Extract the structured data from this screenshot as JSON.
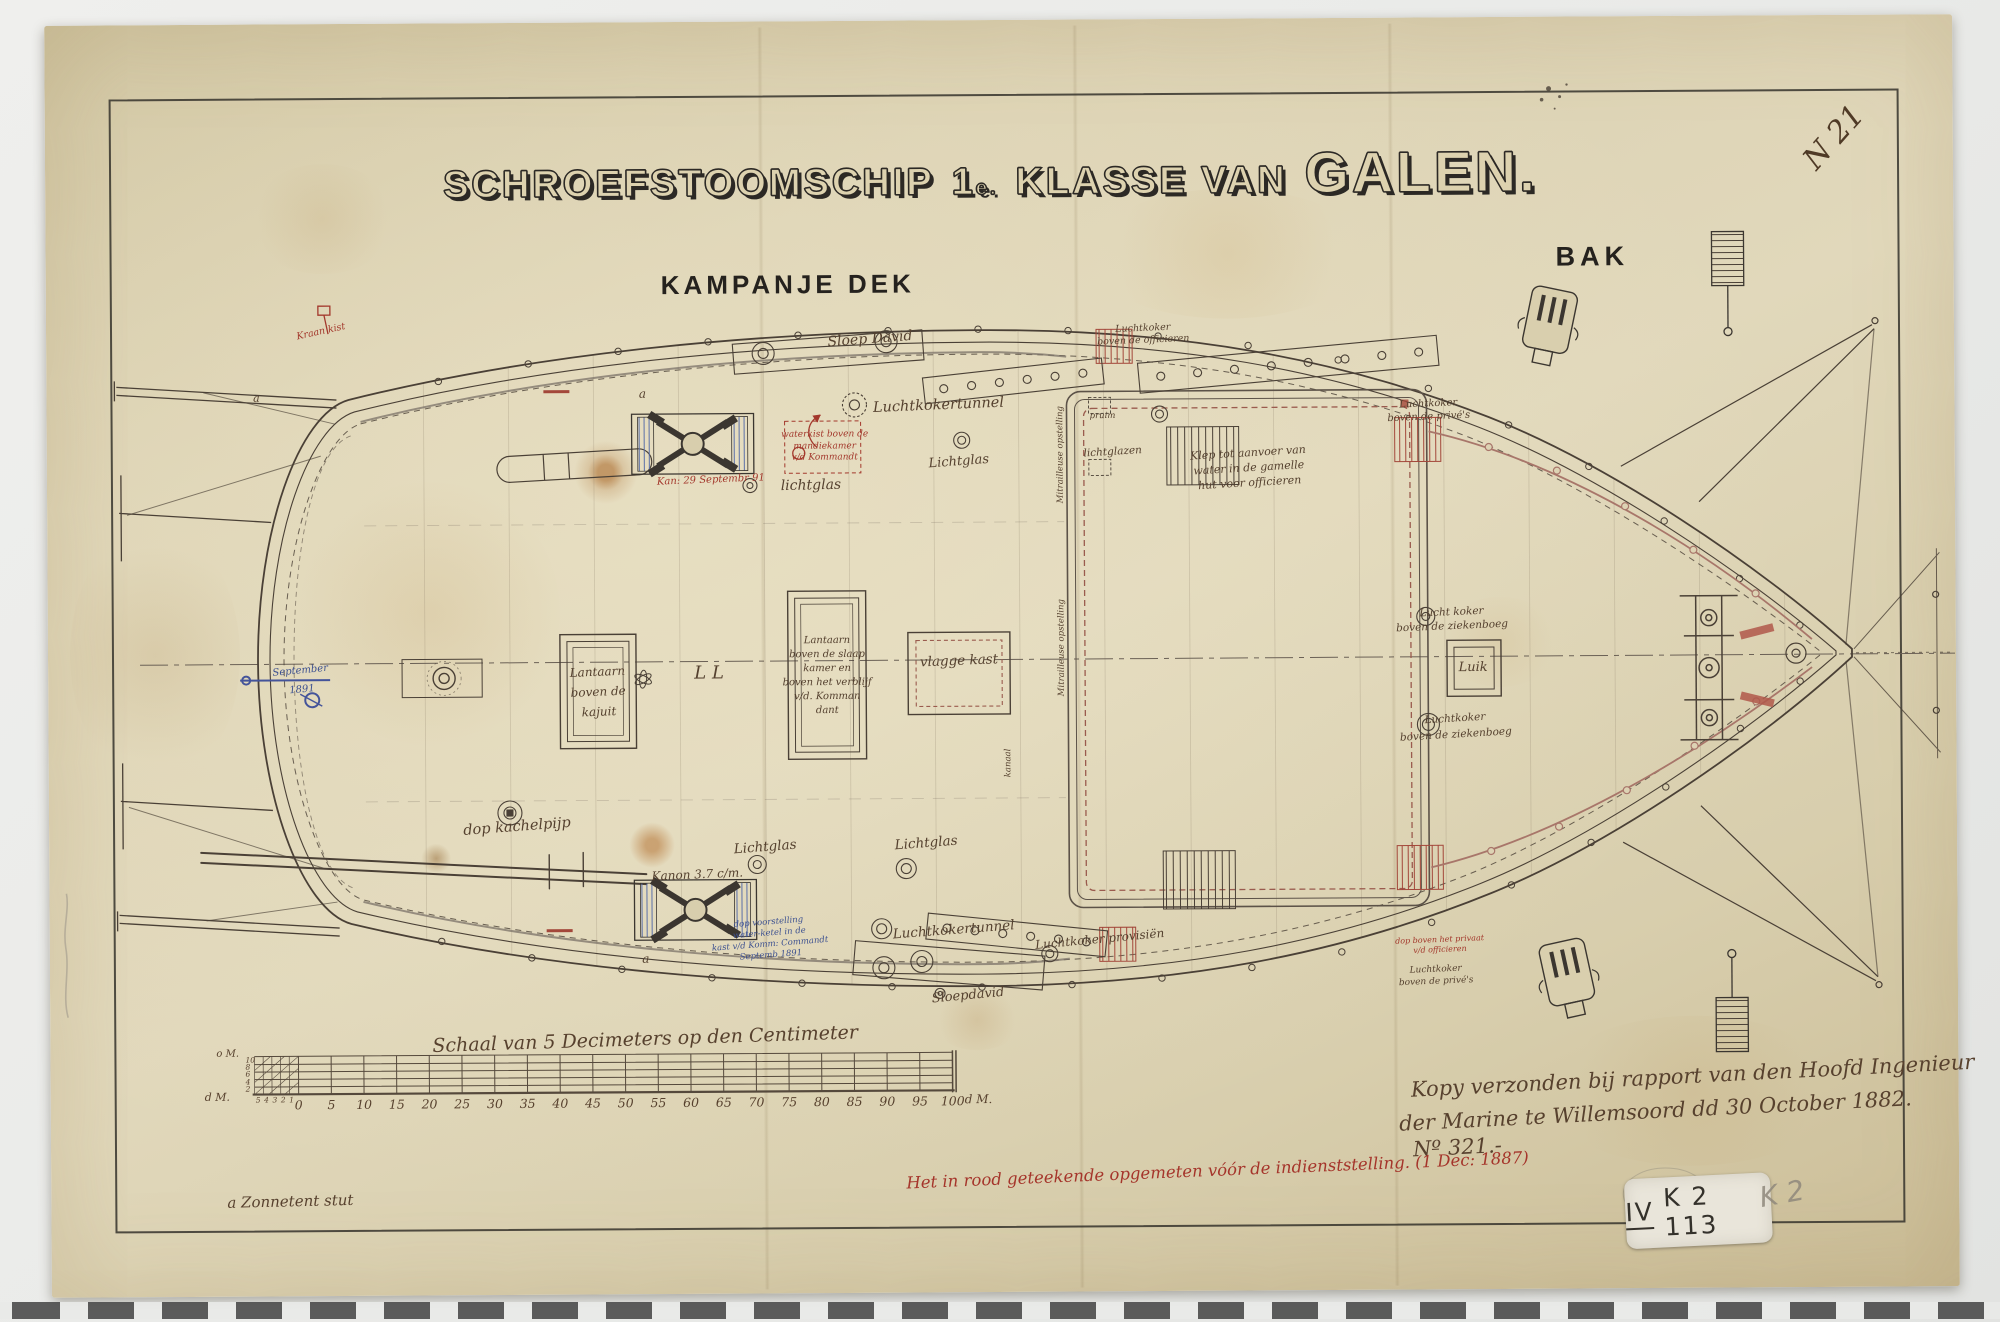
{
  "header": {
    "corner_number": "N 21",
    "title_part1": "SCHROEFSTOOMSCHIP",
    "title_num": "1",
    "title_num_sup": "e.",
    "title_part2": "KLASSE VAN",
    "title_ship": "GALEN.",
    "deck_label_left": "KAMPANJE DEK",
    "deck_label_right": "BAK"
  },
  "plan": {
    "annotations": [
      {
        "t": "Kraan kist",
        "x": 323,
        "y": 328,
        "s": 9.5,
        "c": "red",
        "r": -12
      },
      {
        "t": "Sloep David",
        "x": 872,
        "y": 339,
        "s": 14,
        "c": "ink",
        "r": -4
      },
      {
        "t": "waterkist boven de\nmandiekamer\nv/d Kommandt",
        "x": 826,
        "y": 446,
        "s": 9,
        "c": "red",
        "r": 0,
        "lh": 1.3
      },
      {
        "t": "Luchtkokertunnel",
        "x": 940,
        "y": 405,
        "s": 14.5,
        "c": "ink",
        "r": -2
      },
      {
        "t": "Lichtglas",
        "x": 960,
        "y": 462,
        "s": 13,
        "c": "ink",
        "r": -4
      },
      {
        "t": "Klep tot aanvoer van\nwater in de gamelle\nhut voor officieren",
        "x": 1250,
        "y": 470,
        "s": 11,
        "c": "ink",
        "r": -3,
        "lh": 1.35
      },
      {
        "t": "lichtglazen",
        "x": 1114,
        "y": 453,
        "s": 10.5,
        "c": "ink",
        "r": -3
      },
      {
        "t": "pruim",
        "x": 1104,
        "y": 417,
        "s": 8.5,
        "c": "ink",
        "r": 0
      },
      {
        "t": "Kan: 29 Septembr 91",
        "x": 712,
        "y": 479,
        "s": 10,
        "c": "red",
        "r": -2
      },
      {
        "t": "lichtglas",
        "x": 812,
        "y": 485,
        "s": 14,
        "c": "ink",
        "r": -1
      },
      {
        "t": "Luchtkoker\nboven de privé's",
        "x": 1430,
        "y": 413,
        "s": 10,
        "c": "ink",
        "r": -2,
        "lh": 1.3
      },
      {
        "t": "Lucht koker\nboven de ziekenboeg",
        "x": 1452,
        "y": 622,
        "s": 10.5,
        "c": "ink",
        "r": -2,
        "lh": 1.35
      },
      {
        "t": "Luik",
        "x": 1473,
        "y": 671,
        "s": 13,
        "c": "ink",
        "r": 0
      },
      {
        "t": "Luchtkoker\nboven de ziekenboeg",
        "x": 1455,
        "y": 730,
        "s": 10.5,
        "c": "ink",
        "r": -3,
        "lh": 1.5
      },
      {
        "t": "September\n1891",
        "x": 301,
        "y": 676,
        "s": 10,
        "c": "blue",
        "r": -5,
        "lh": 1.9
      },
      {
        "t": "Lantaarn\nboven de\nkajuit",
        "x": 598,
        "y": 690,
        "s": 12,
        "c": "ink",
        "r": -2,
        "lh": 1.65
      },
      {
        "t": "L L",
        "x": 709,
        "y": 672,
        "s": 18,
        "c": "ink",
        "r": 0
      },
      {
        "t": "Lantaarn\nboven de slaap\nkamer en\nboven het verblijf\nv/d. Komman\ndant",
        "x": 827,
        "y": 675,
        "s": 10,
        "c": "ink",
        "r": 0,
        "lh": 1.4
      },
      {
        "t": "vlagge kast",
        "x": 959,
        "y": 661,
        "s": 13.5,
        "c": "ink",
        "r": -2
      },
      {
        "t": "dop kachelpijp",
        "x": 516,
        "y": 824,
        "s": 14.5,
        "c": "ink",
        "r": -4
      },
      {
        "t": "Lichtglas",
        "x": 764,
        "y": 846,
        "s": 13.5,
        "c": "ink",
        "r": -4
      },
      {
        "t": "Lichtglas",
        "x": 925,
        "y": 843,
        "s": 13.5,
        "c": "ink",
        "r": -4
      },
      {
        "t": "Kanon 3.7 c/m.",
        "x": 696,
        "y": 873,
        "s": 12,
        "c": "ink",
        "r": -2
      },
      {
        "t": "dop voorstelling\nwater-ketel in de\nkast v/d Komm: Commandt\nSeptemb 1891",
        "x": 768,
        "y": 938,
        "s": 8.5,
        "c": "blue",
        "r": -4,
        "lh": 1.3
      },
      {
        "t": "Luchtkokertunnel",
        "x": 952,
        "y": 930,
        "s": 13.5,
        "c": "ink",
        "r": -4
      },
      {
        "t": "Luchtkoker provisiën",
        "x": 1098,
        "y": 940,
        "s": 12,
        "c": "ink",
        "r": -5
      },
      {
        "t": "Sloepdavid",
        "x": 966,
        "y": 996,
        "s": 13,
        "c": "ink",
        "r": -5
      },
      {
        "t": "dop boven het privaat\nv/d officieren",
        "x": 1438,
        "y": 948,
        "s": 8,
        "c": "red",
        "r": -2,
        "lh": 1.3
      },
      {
        "t": "Luchtkoker\nboven de privé's",
        "x": 1434,
        "y": 979,
        "s": 9,
        "c": "ink",
        "r": -2,
        "lh": 1.3
      },
      {
        "t": "Luchtkoker\nboven de officieren",
        "x": 1145,
        "y": 336,
        "s": 9.5,
        "c": "ink",
        "r": -2,
        "lh": 1.3
      },
      {
        "t": "Mitrailleuse opstelling",
        "x": 1062,
        "y": 455,
        "s": 8.5,
        "c": "ink",
        "r": -90
      },
      {
        "t": "Mitrailleuse opstelling",
        "x": 1062,
        "y": 648,
        "s": 8.5,
        "c": "ink",
        "r": -90
      },
      {
        "t": "kanaal",
        "x": 1008,
        "y": 763,
        "s": 8.5,
        "c": "ink",
        "r": -90
      },
      {
        "t": "a",
        "x": 644,
        "y": 392,
        "s": 12,
        "c": "ink",
        "r": 0
      },
      {
        "t": "a",
        "x": 644,
        "y": 957,
        "s": 12,
        "c": "ink",
        "r": 0
      },
      {
        "t": "a",
        "x": 258,
        "y": 394,
        "s": 11,
        "c": "ink",
        "r": 0
      }
    ]
  },
  "scale_bar": {
    "title": "Schaal van 5 Decimeters op den Centimeter",
    "tick_labels": [
      "0",
      "5",
      "10",
      "15",
      "20",
      "25",
      "30",
      "35",
      "40",
      "45",
      "50",
      "55",
      "60",
      "65",
      "70",
      "75",
      "80",
      "85",
      "90",
      "95",
      "100"
    ],
    "unit_right": "d M.",
    "unit_left": "d M.",
    "unit_left_top": "o M.",
    "left_values": [
      "10",
      "8",
      "6",
      "4",
      "2"
    ],
    "left_sub_values": [
      "5",
      "4",
      "3",
      "2",
      "1"
    ]
  },
  "notes": {
    "kopy_lines": [
      "Kopy verzonden bij rapport van den Hoofd Ingenieur",
      "der Marine te Willemsoord dd 30 October 1882.",
      "Nº 321.-"
    ],
    "red_note": "Het in rood geteekende opgemeten vóór de indienststelling. (1 Dec: 1887)",
    "legend_note": "a Zonnetent stut"
  },
  "stamps": {
    "sticker_roman": "IV",
    "sticker_rest": "K 2 113",
    "pencil_note": "K 2"
  },
  "colors": {
    "ink": "#55412f",
    "red": "#a3382c",
    "blue": "#3d5190",
    "pencil": "#8f887c"
  }
}
